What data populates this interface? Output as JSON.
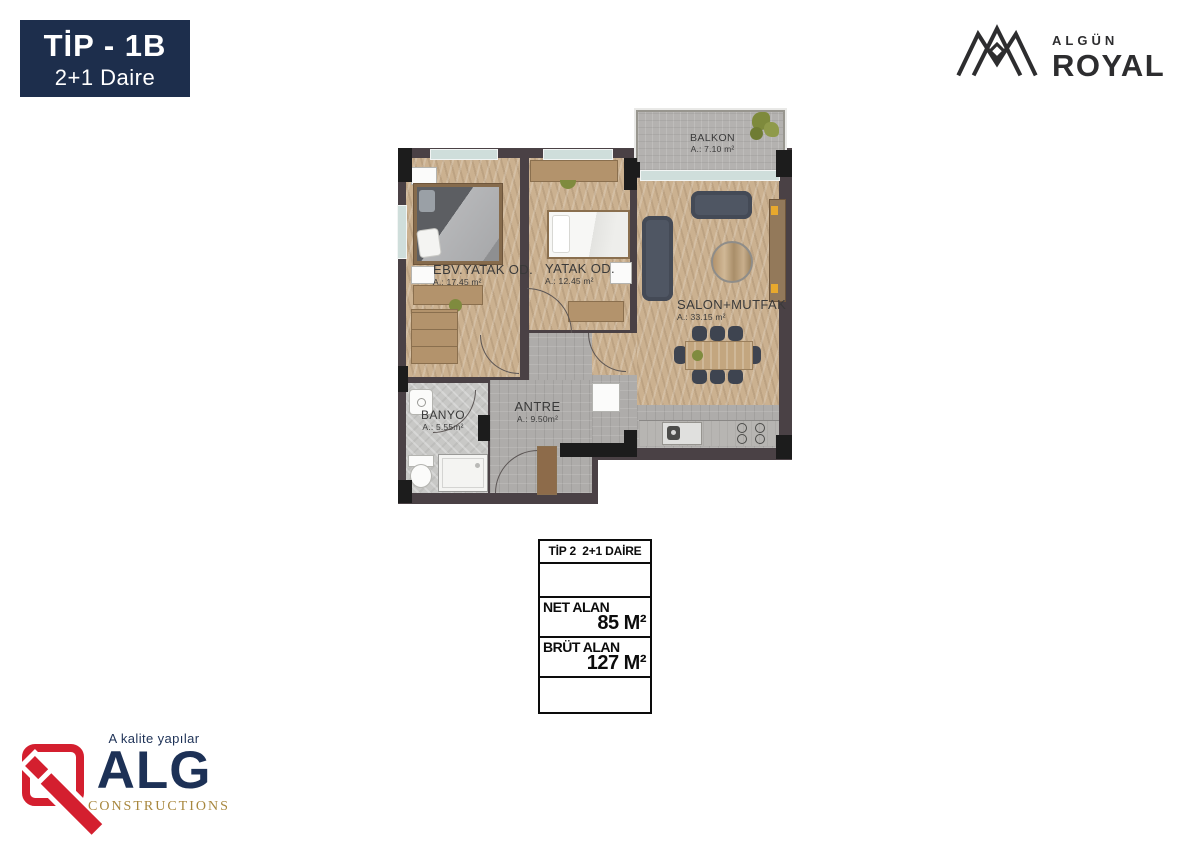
{
  "badge": {
    "title": "TİP - 1B",
    "subtitle": "2+1 Daire",
    "bg_color": "#1d2e4c",
    "text_color": "#ffffff"
  },
  "brand_top_right": {
    "icon": "crown-icon",
    "name_small": "ALGÜN",
    "name_large": "ROYAL",
    "color": "#2d2d2f"
  },
  "floor_plan": {
    "rooms": [
      {
        "id": "balkon",
        "name": "BALKON",
        "area": "A.: 7.10 m²"
      },
      {
        "id": "ebv-yatak-od",
        "name": "EBV.YATAK OD.",
        "area": "A.: 17.45 m²"
      },
      {
        "id": "yatak-od",
        "name": "YATAK OD.",
        "area": "A.: 12.45 m²"
      },
      {
        "id": "salon-mutfak",
        "name": "SALON+MUTFAK",
        "area": "A.: 33.15 m²"
      },
      {
        "id": "antre",
        "name": "ANTRE",
        "area": "A.: 9.50m²"
      },
      {
        "id": "banyo",
        "name": "BANYO",
        "area": "A.: 5.55m²"
      }
    ],
    "colors": {
      "wall": "#4a4145",
      "wood_floor": "#cbb190",
      "gray_tile": "#aeacaa",
      "bath_tile": "#c8c8c6",
      "balcony_tile": "#b4b2b0",
      "sofa": "#4f5663",
      "window": "#cfdedb",
      "furniture_wood": "#b3936c",
      "accent_yellow": "#e8a92d"
    }
  },
  "spec_table": {
    "header": "TİP 2  2+1 DAİRE",
    "rows": [
      {
        "label": "NET ALAN",
        "value": "85 M²"
      },
      {
        "label": "BRÜT ALAN",
        "value": "127 M²"
      }
    ]
  },
  "brand_bottom_left": {
    "icon": "alg-mark-icon",
    "tagline": "A kalite yapılar",
    "name": "ALG",
    "subtitle": "CONSTRUCTIONS",
    "colors": {
      "navy": "#1d3156",
      "gold": "#a8873e",
      "red": "#d41f2f"
    }
  }
}
